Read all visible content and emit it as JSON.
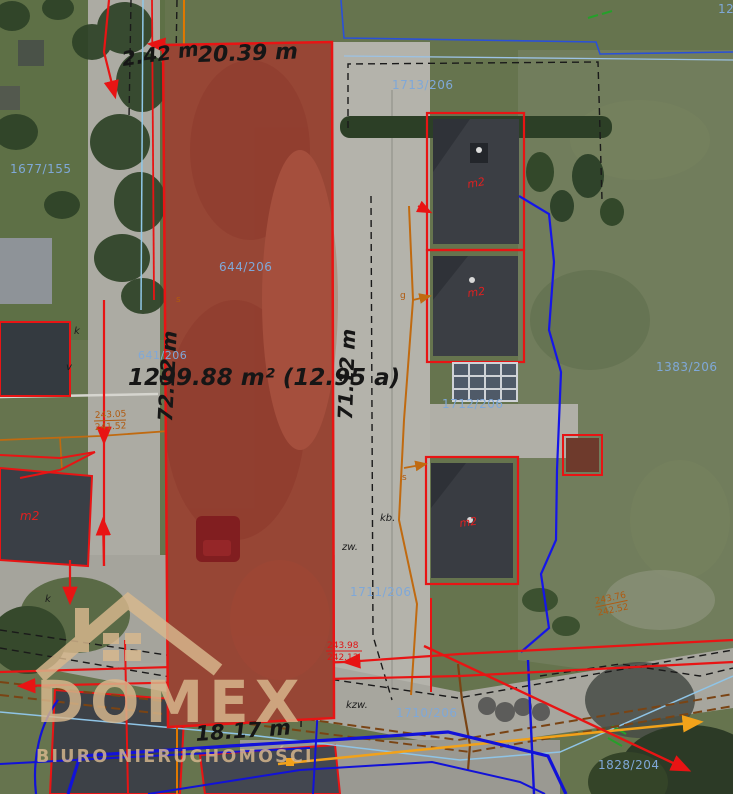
{
  "map": {
    "dims": {
      "top_offset": "2.42 m",
      "top": "20.39 m",
      "left": "72.12 m",
      "right": "71.12 m",
      "bottom": "18.17 m",
      "area": "1299.88 m² (12.95 a)"
    },
    "parcels": {
      "p1677_155": "1677/155",
      "p1713_206": "1713/206",
      "p644_206": "644/206",
      "p641_206": "641/206",
      "p1712_206": "1712/206",
      "p1383_206": "1383/206",
      "p1711_206": "1711/206",
      "p1710_206": "1710/206",
      "p1828_204": "1828/204",
      "partial_top_right": "12"
    },
    "buildings": {
      "house_code": "m2"
    },
    "elevations": {
      "red_a": "243.98",
      "red_b": "242.13",
      "right_a": "243.76",
      "right_b": "242.52",
      "left_a": "243.05",
      "left_b": "241.52"
    },
    "letters": {
      "k": "k",
      "v": "v",
      "kb": "kb.",
      "zw": "zw.",
      "kzw": "kzw.",
      "s": "s",
      "g": "g"
    },
    "colors": {
      "parcel_red": "#e81414",
      "parcel_fill": "rgba(205,30,25,0.33)",
      "boundary_blue": "#2a50d8",
      "label_blue": "#7fa8d8",
      "utility_orange": "#e07800",
      "utility_brown": "#7a4414",
      "utility_blue": "#1515e8",
      "watermark_tan": "#d9b98e"
    }
  },
  "watermark": {
    "title": "DOMEX",
    "subtitle": "BIURO NIERUCHOMOŚCI"
  }
}
